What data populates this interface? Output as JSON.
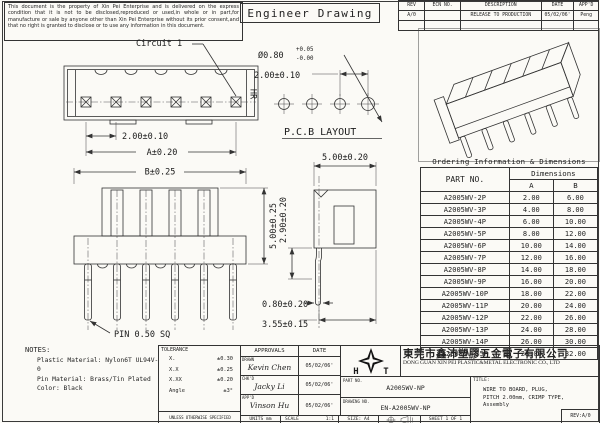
{
  "page": {
    "disclaimer": "This document is the property of Xin Pei Enterprise and is delivered on the express condition that it is not to be disclosed,reproduced or used,in whole or in part,for manufacture or sale by anyone other than Xin Pei Enterprise without its prior consent,and that no right is granted to disclose or to use any information in this document.",
    "drawing_title": "Engineer Drawing"
  },
  "revision_table": {
    "headers": {
      "rev": "REV",
      "ecn": "ECN NO.",
      "description": "DESCRIPTION",
      "date": "DATE",
      "appd": "APP'D"
    },
    "row": {
      "rev": "A/0",
      "ecn": "",
      "description": "RELEASE TO PRODUCTION",
      "date": "05/02/06'",
      "appd": "Peng"
    }
  },
  "front_view": {
    "circuit_label": "Circuit 1",
    "marking": "HR",
    "dim_pitch": "2.00±0.10",
    "dim_overall": "A±0.20"
  },
  "pcb_layout": {
    "dim_hole": "Ø0.80",
    "tol_plus": "+0.05",
    "tol_minus": "-0.00",
    "dim_pitch": "2.00±0.10",
    "caption": "P.C.B LAYOUT"
  },
  "top_view": {
    "dim_overall": "B±0.25",
    "dim_height": "5.00±0.25",
    "pin_label": "PIN 0.50 SQ"
  },
  "side_view": {
    "dim_width": "5.00±0.20",
    "dim_depth": "2.90±0.20",
    "dim_pin_width": "0.80±0.20",
    "dim_pin_offset": "3.55±0.15"
  },
  "ordering_table": {
    "title": "Ordering Information & Dimensions",
    "col_part_no": "PART NO.",
    "col_dimensions": "Dimensions",
    "col_a": "A",
    "col_b": "B",
    "rows": [
      [
        "A2005WV-2P",
        "2.00",
        "6.00"
      ],
      [
        "A2005WV-3P",
        "4.00",
        "8.00"
      ],
      [
        "A2005WV-4P",
        "6.00",
        "10.00"
      ],
      [
        "A2005WV-5P",
        "8.00",
        "12.00"
      ],
      [
        "A2005WV-6P",
        "10.00",
        "14.00"
      ],
      [
        "A2005WV-7P",
        "12.00",
        "16.00"
      ],
      [
        "A2005WV-8P",
        "14.00",
        "18.00"
      ],
      [
        "A2005WV-9P",
        "16.00",
        "20.00"
      ],
      [
        "A2005WV-10P",
        "18.00",
        "22.00"
      ],
      [
        "A2005WV-11P",
        "20.00",
        "24.00"
      ],
      [
        "A2005WV-12P",
        "22.00",
        "26.00"
      ],
      [
        "A2005WV-13P",
        "24.00",
        "28.00"
      ],
      [
        "A2005WV-14P",
        "26.00",
        "30.00"
      ],
      [
        "A2005WV-15P",
        "28.00",
        "32.00"
      ]
    ]
  },
  "notes": {
    "heading": "NOTES:",
    "line1": "Plastic Material: Nylon6T UL94V-0",
    "line2": "Pin Material: Brass/Tin Plated",
    "line3": "Color: Black"
  },
  "title_block": {
    "tolerance": {
      "heading": "TOLERANCE",
      "r1l": "X.",
      "r1v": "±0.30",
      "r2l": "X.X",
      "r2v": "±0.25",
      "r3l": "X.XX",
      "r3v": "±0.20",
      "r4l": "Angle",
      "r4v": "±3°",
      "footer": "UNLESS OTHERWISE SPECIFIED"
    },
    "approvals": {
      "heading": "APPROVALS",
      "date_heading": "DATE",
      "drawn_label": "DRAWN",
      "drawn_name": "Kevin Chen",
      "drawn_date": "05/02/06'",
      "chkd_label": "CHK'D",
      "chkd_name": "Jacky Li",
      "chkd_date": "05/02/06'",
      "appd_label": "APP'D",
      "appd_name": "Vinson Hu",
      "appd_date": "05/02/06'"
    },
    "units": "UNITS  mm",
    "scale": "SCALE",
    "scale_value": "1:1",
    "size": "SIZE: A4",
    "sheet": "SHEET  1  OF  1",
    "logo_left": "H",
    "logo_right": "T",
    "company_cn": "東莞市鑫沛塑膠五金電子有限公司",
    "company_en": "DONG GUAN XIN PEI PLASTIC&METAL ELECTRONIC CO., LTD",
    "part_no_label": "PART NO.",
    "part_no": "A2005WV-NP",
    "drawing_no_label": "DRAWING NO.",
    "drawing_no": "EN-A2005WV-NP",
    "title_label": "TITLE:",
    "title_line1": "WIRE TO BOARD, PLUG,",
    "title_line2": "PITCH 2.00mm, CRIMP TYPE,",
    "title_line3": "Assembly",
    "rev": "REV:A/0"
  }
}
